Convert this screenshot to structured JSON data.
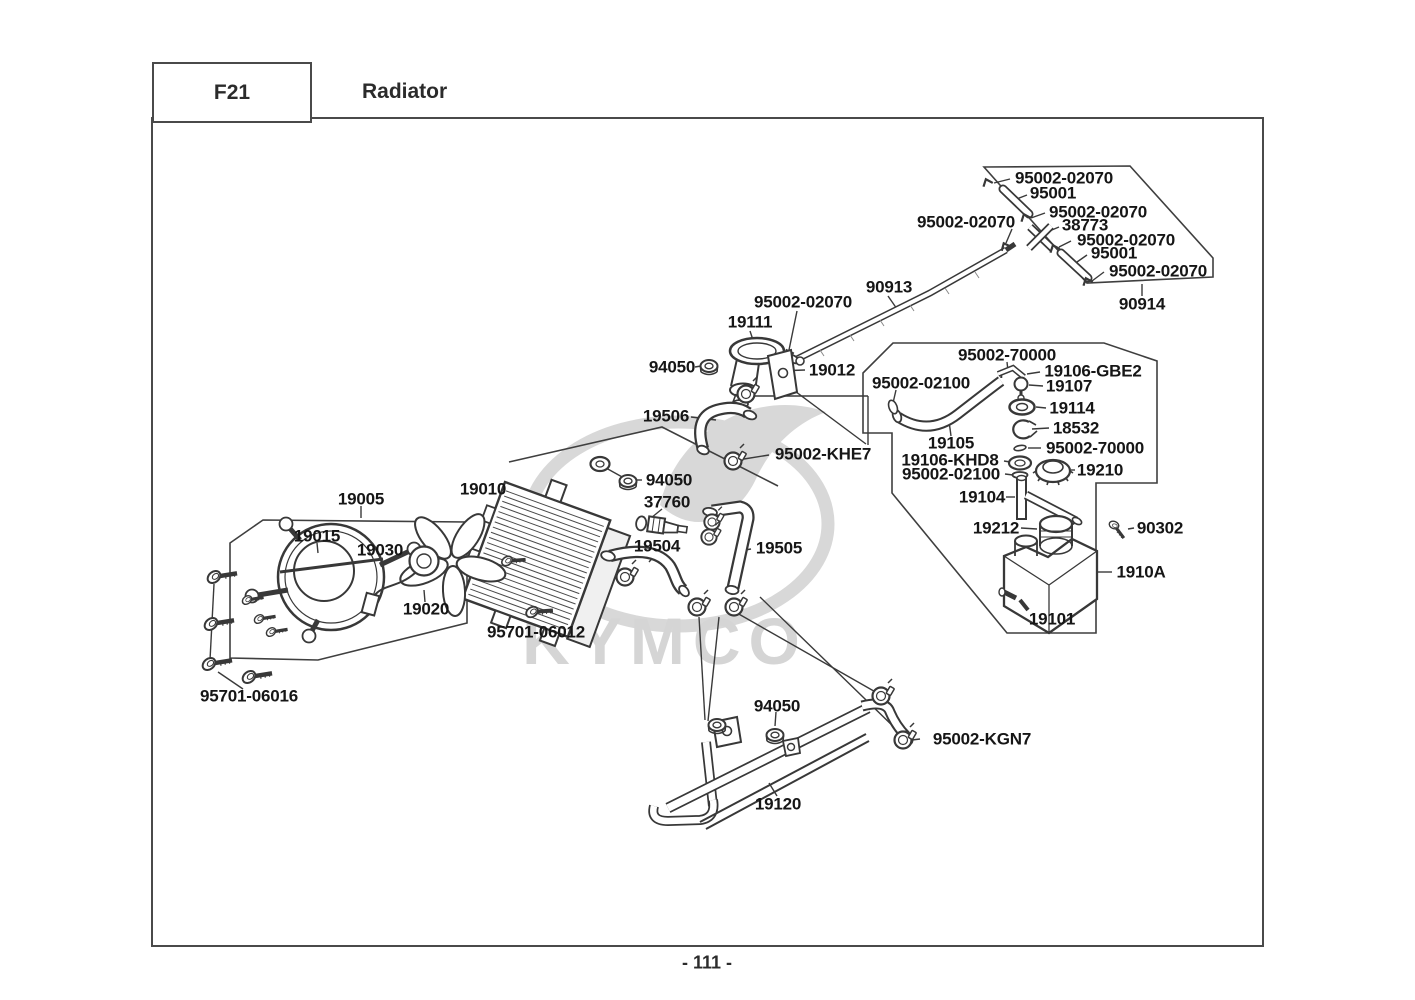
{
  "header": {
    "code": "F21",
    "title": "Radiator"
  },
  "page_number": "- 111 -",
  "watermark": {
    "text": "KYMCO"
  },
  "part_labels": [
    {
      "id": "clip-top-1",
      "text": "95002-02070"
    },
    {
      "id": "tube-top-1",
      "text": "95001"
    },
    {
      "id": "clip-top-2",
      "text": "95002-02070"
    },
    {
      "id": "three-way-joint",
      "text": "38773"
    },
    {
      "id": "clip-top-3",
      "text": "95002-02070"
    },
    {
      "id": "tube-top-2",
      "text": "95001"
    },
    {
      "id": "clip-top-4",
      "text": "95002-02070"
    },
    {
      "id": "tube-comp-b",
      "text": "90914"
    },
    {
      "id": "clip-top-5",
      "text": "95002-02070"
    },
    {
      "id": "tube-comp-a",
      "text": "90913"
    },
    {
      "id": "clip-top-6",
      "text": "95002-02070"
    },
    {
      "id": "filler-neck",
      "text": "19111"
    },
    {
      "id": "joint-filler",
      "text": "19012"
    },
    {
      "id": "nut-a",
      "text": "94050"
    },
    {
      "id": "hose-upper",
      "text": "19506"
    },
    {
      "id": "clamp-khe7",
      "text": "95002-KHE7"
    },
    {
      "id": "clip-70000-a",
      "text": "95002-70000"
    },
    {
      "id": "joint-gbe2",
      "text": "19106-GBE2"
    },
    {
      "id": "clip-02100-a",
      "text": "95002-02100"
    },
    {
      "id": "joint-19107",
      "text": "19107"
    },
    {
      "id": "grommet-19114",
      "text": "19114"
    },
    {
      "id": "clamp-18532",
      "text": "18532"
    },
    {
      "id": "hose-reserve",
      "text": "19105"
    },
    {
      "id": "clip-70000-b",
      "text": "95002-70000"
    },
    {
      "id": "joint-khd8",
      "text": "19106-KHD8"
    },
    {
      "id": "clip-02100-b",
      "text": "95002-02100"
    },
    {
      "id": "cap-reserve",
      "text": "19210"
    },
    {
      "id": "tube-siphon",
      "text": "19104"
    },
    {
      "id": "neck-reserve",
      "text": "19212"
    },
    {
      "id": "screw-90302",
      "text": "90302"
    },
    {
      "id": "tank-assy",
      "text": "1910A"
    },
    {
      "id": "tank-body",
      "text": "19101"
    },
    {
      "id": "fan-assy",
      "text": "19005"
    },
    {
      "id": "fan-shroud",
      "text": "19015"
    },
    {
      "id": "fan-motor",
      "text": "19030"
    },
    {
      "id": "fan-blade",
      "text": "19020"
    },
    {
      "id": "bolt-06016",
      "text": "95701-06016"
    },
    {
      "id": "radiator",
      "text": "19010"
    },
    {
      "id": "nut-b",
      "text": "94050"
    },
    {
      "id": "thermo-sensor",
      "text": "37760"
    },
    {
      "id": "hose-lower",
      "text": "19504"
    },
    {
      "id": "hose-middle",
      "text": "19505"
    },
    {
      "id": "bolt-06012",
      "text": "95701-06012"
    },
    {
      "id": "nut-c",
      "text": "94050"
    },
    {
      "id": "clamp-kgn7",
      "text": "95002-KGN7"
    },
    {
      "id": "water-pipe",
      "text": "19120"
    }
  ]
}
